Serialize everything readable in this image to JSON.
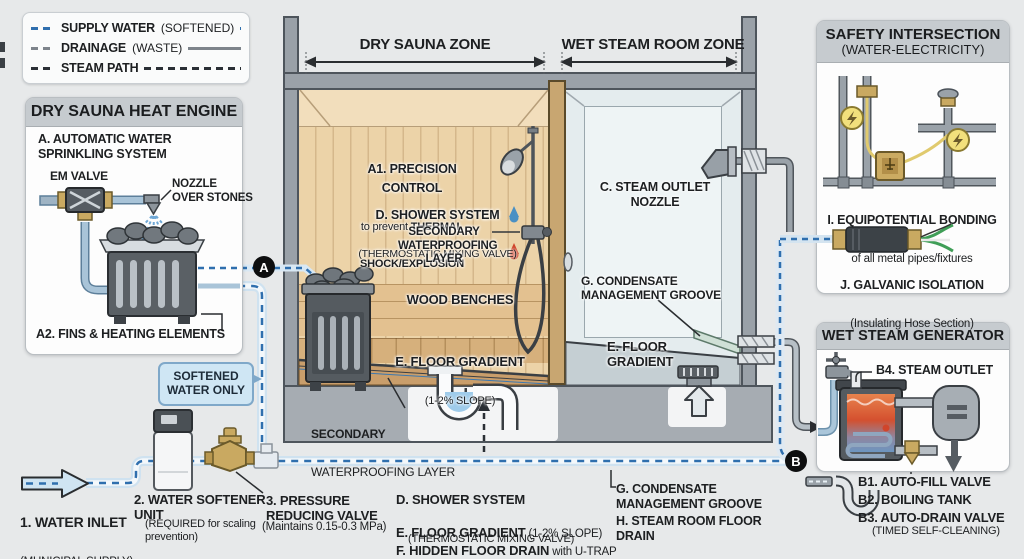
{
  "legend": {
    "items": [
      {
        "label": "SUPPLY WATER",
        "suffix": "(SOFTENED)",
        "color": "#2f6fae",
        "style": "dashed"
      },
      {
        "label": "DRAINAGE",
        "suffix": "(WASTE)",
        "color": "#7d848b",
        "style": "solid"
      },
      {
        "label": "STEAM PATH",
        "suffix": "",
        "color": "#2a2f35",
        "style": "dashed"
      }
    ]
  },
  "zones": {
    "dry": "DRY SAUNA ZONE",
    "wet": "WET STEAM ROOM ZONE"
  },
  "heat_engine": {
    "title": "DRY SAUNA HEAT ENGINE",
    "item_a": "A. AUTOMATIC WATER\nSPRINKLING SYSTEM",
    "em_valve": "EM VALVE",
    "nozzle": "NOZZLE\nOVER STONES",
    "item_a2": "A2. FINS & HEATING ELEMENTS"
  },
  "sauna": {
    "a1_title": "A1. PRECISION CONTROL",
    "a1_l2a": "to prevent ",
    "a1_l2b": "THERMAL",
    "a1_l3": "SHOCK/EXPLOSION",
    "shower_title": "D. SHOWER SYSTEM",
    "shower_sub": "(THERMOSTATIC MIXING VALVE)",
    "waterproof": "SECONDARY\nWATERPROOFING\nLAYER",
    "benches": "WOOD BENCHES",
    "floor_title": "E. FLOOR GRADIENT",
    "floor_sub": "(1-2% SLOPE)",
    "sub_wp_l1": "SECONDARY",
    "sub_wp_l2": "WATERPROOFING LAYER"
  },
  "steam_room": {
    "nozzle": "C. STEAM OUTLET\nNOZZLE",
    "condensate": "G. CONDENSATE\nMANAGEMENT GROOVE",
    "floor": "E. FLOOR\nGRADIENT"
  },
  "safety": {
    "title": "SAFETY INTERSECTION",
    "subtitle": "(WATER-ELECTRICITY)",
    "i_title": "I. EQUIPOTENTIAL BONDING",
    "i_sub": "of all metal pipes/fixtures",
    "j_title": "J. GALVANIC ISOLATION",
    "j_sub": "(Insulating Hose Section)"
  },
  "generator": {
    "title": "WET STEAM GENERATOR",
    "b4": "B4. STEAM OUTLET",
    "b1": "B1. AUTO-FILL VALVE",
    "b2": "B2. BOILING TANK",
    "b3": "B3. AUTO-DRAIN VALVE",
    "b3_sub": "(TIMED SELF-CLEANING)"
  },
  "supply": {
    "callout": "SOFTENED\nWATER ONLY",
    "inlet_title": "1. WATER INLET",
    "inlet_sub": "(MUNICIPAL SUPPLY)",
    "softener_title": "2. WATER SOFTENER\nUNIT",
    "softener_sub": "(REQUIRED for scaling\nprevention)",
    "valve_title": "3. PRESSURE\nREDUCING VALVE",
    "valve_sub": "(Maintains 0.15-0.3 MPa)"
  },
  "bottom": {
    "d_title": "D. SHOWER SYSTEM",
    "d_sub": "(THERMOSTATIC MIXING VALVE)",
    "e_title": "E. FLOOR GRADIENT",
    "e_sub": " (1-2% SLOPE)",
    "f_title": "F. HIDDEN FLOOR DRAIN",
    "f_sub": " with U-TRAP",
    "g": "G. CONDENSATE\nMANAGEMENT GROOVE",
    "h": "H. STEAM ROOM FLOOR\nDRAIN"
  },
  "markers": {
    "a": "A",
    "b": "B"
  },
  "colors": {
    "supply_dash": "#2f6fae",
    "drainage": "#7d848b",
    "steam_dash": "#2a2f35",
    "wood": "#ecd3a8",
    "brass": "#c9a961",
    "hot_drop": "#d0452b",
    "cold_drop": "#4a90c4",
    "boil_hot": "#d4502f",
    "boil_cold": "#6d95c0"
  }
}
